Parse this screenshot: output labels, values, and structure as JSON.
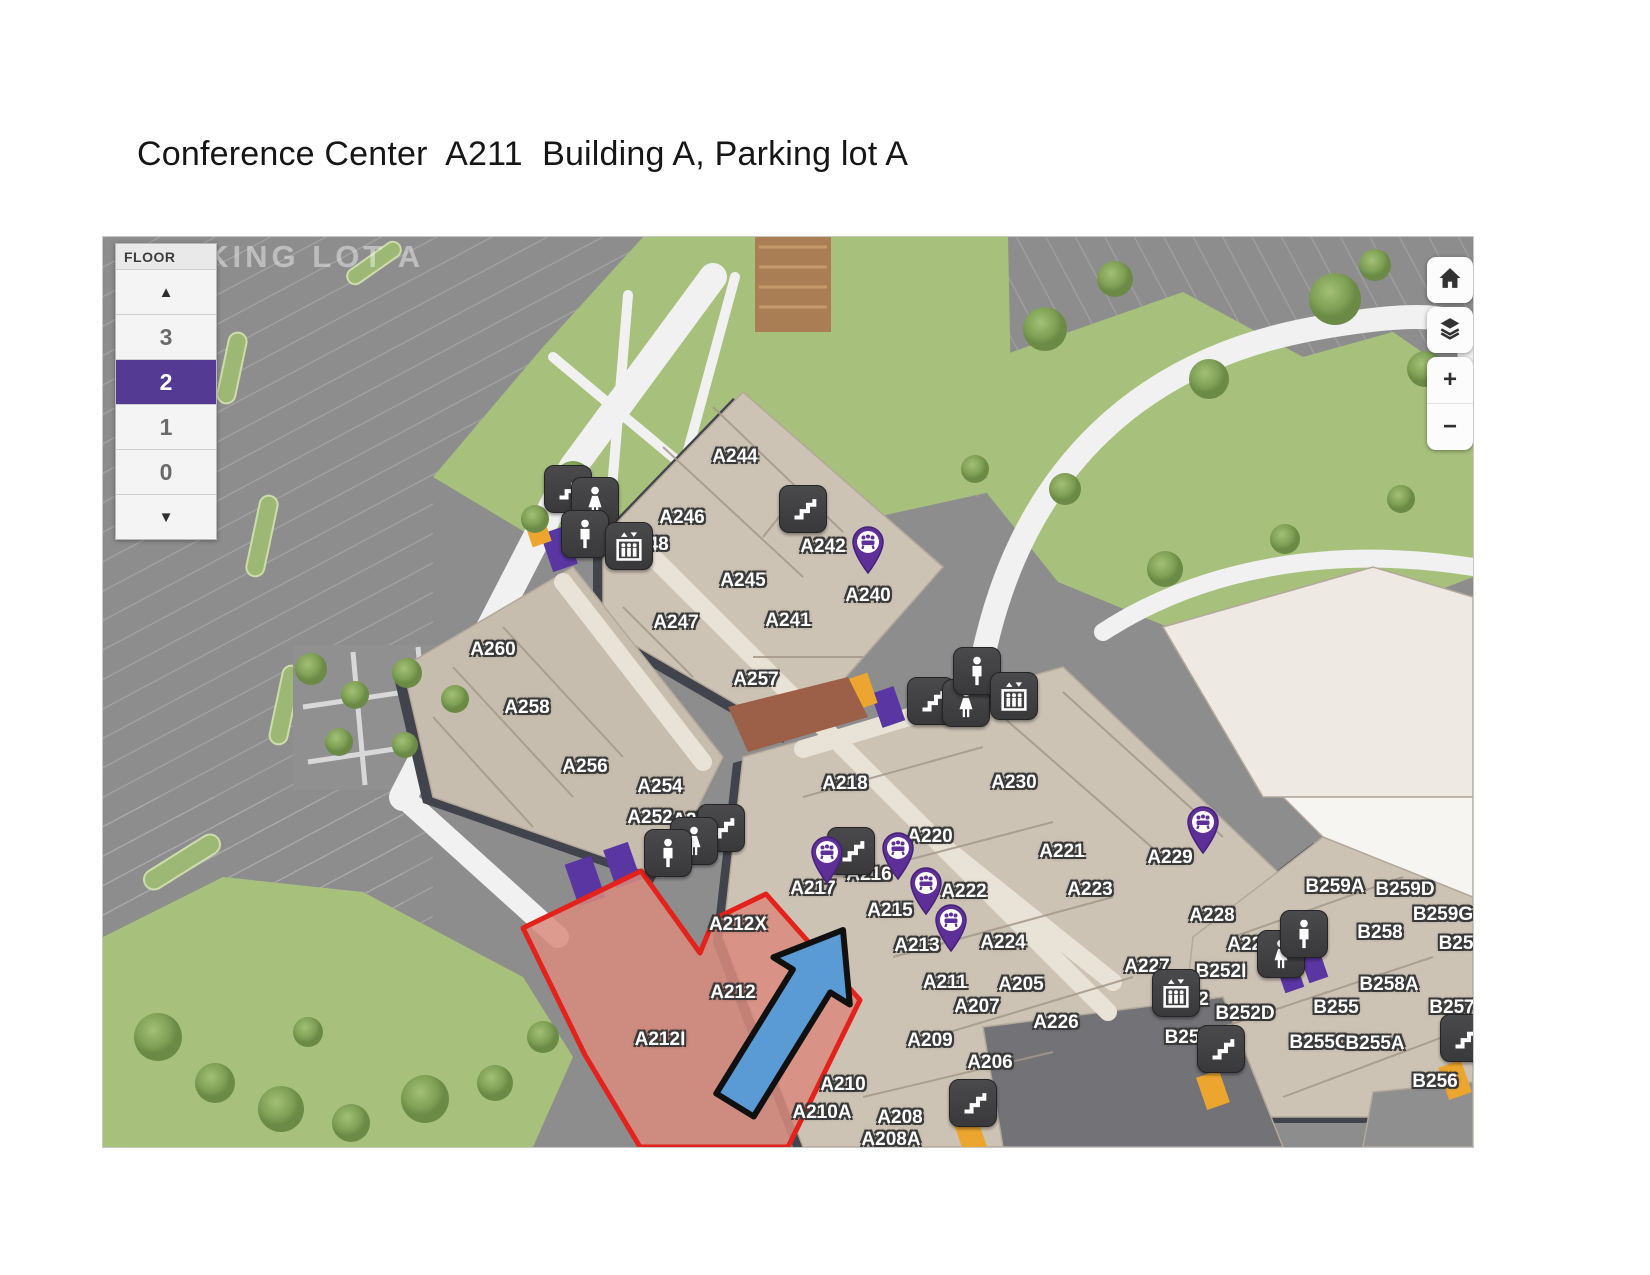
{
  "title": "Conference Center  A211  Building A, Parking lot A",
  "map": {
    "parking_lot_label": "PARKING LOT A",
    "floor_panel": {
      "header": "FLOOR",
      "up_arrow": "▲",
      "down_arrow": "▼",
      "floors": [
        "3",
        "2",
        "1",
        "0"
      ],
      "selected_floor": "2",
      "selected_color": "#543a93"
    },
    "controls": {
      "home": "home",
      "layers": "layers",
      "zoom_in": "+",
      "zoom_out": "−"
    },
    "colors": {
      "highlight_fill": "#d98b7e",
      "highlight_stroke": "#e3221b",
      "arrow_blue": "#5b9bd5",
      "pin_purple": "#5e2f96",
      "building_tan": "#cdc3b5",
      "parking_gray": "#8d8d8d",
      "grass_green": "#a7c07c"
    },
    "highlight_rooms": [
      "A212X",
      "A212",
      "A212I"
    ],
    "rooms": [
      {
        "label": "A244",
        "x": 632,
        "y": 220
      },
      {
        "label": "A246",
        "x": 579,
        "y": 281
      },
      {
        "label": "A248",
        "x": 543,
        "y": 308
      },
      {
        "label": "A242",
        "x": 720,
        "y": 310
      },
      {
        "label": "A245",
        "x": 640,
        "y": 344
      },
      {
        "label": "A240",
        "x": 765,
        "y": 359
      },
      {
        "label": "A247",
        "x": 573,
        "y": 386
      },
      {
        "label": "A241",
        "x": 685,
        "y": 384
      },
      {
        "label": "A260",
        "x": 390,
        "y": 413
      },
      {
        "label": "A257",
        "x": 653,
        "y": 443
      },
      {
        "label": "A258",
        "x": 424,
        "y": 471
      },
      {
        "label": "A256",
        "x": 482,
        "y": 530
      },
      {
        "label": "A254",
        "x": 557,
        "y": 550
      },
      {
        "label": "A252",
        "x": 547,
        "y": 581
      },
      {
        "label": "A250",
        "x": 592,
        "y": 584
      },
      {
        "label": "A218",
        "x": 742,
        "y": 547
      },
      {
        "label": "A230",
        "x": 911,
        "y": 546
      },
      {
        "label": "A220",
        "x": 827,
        "y": 600
      },
      {
        "label": "A221",
        "x": 959,
        "y": 615
      },
      {
        "label": "A216",
        "x": 766,
        "y": 638
      },
      {
        "label": "A217",
        "x": 710,
        "y": 652
      },
      {
        "label": "A222",
        "x": 861,
        "y": 655
      },
      {
        "label": "A223",
        "x": 987,
        "y": 653
      },
      {
        "label": "A215",
        "x": 787,
        "y": 674
      },
      {
        "label": "A213",
        "x": 814,
        "y": 709
      },
      {
        "label": "A224",
        "x": 900,
        "y": 706
      },
      {
        "label": "A229",
        "x": 1067,
        "y": 621
      },
      {
        "label": "A228",
        "x": 1109,
        "y": 679
      },
      {
        "label": "A227",
        "x": 1044,
        "y": 730
      },
      {
        "label": "A225",
        "x": 1147,
        "y": 708
      },
      {
        "label": "A211",
        "x": 842,
        "y": 746
      },
      {
        "label": "A205",
        "x": 918,
        "y": 748
      },
      {
        "label": "A207",
        "x": 874,
        "y": 770
      },
      {
        "label": "A226",
        "x": 953,
        "y": 786
      },
      {
        "label": "A209",
        "x": 827,
        "y": 804
      },
      {
        "label": "A206",
        "x": 887,
        "y": 826
      },
      {
        "label": "A210",
        "x": 740,
        "y": 848
      },
      {
        "label": "A210A",
        "x": 719,
        "y": 876
      },
      {
        "label": "A208",
        "x": 797,
        "y": 881
      },
      {
        "label": "A208A",
        "x": 788,
        "y": 903
      },
      {
        "label": "A212X",
        "x": 635,
        "y": 688
      },
      {
        "label": "A212",
        "x": 630,
        "y": 756
      },
      {
        "label": "A212I",
        "x": 557,
        "y": 803
      },
      {
        "label": "B259A",
        "x": 1232,
        "y": 650
      },
      {
        "label": "B259D",
        "x": 1302,
        "y": 653
      },
      {
        "label": "B259G",
        "x": 1340,
        "y": 678
      },
      {
        "label": "B258",
        "x": 1277,
        "y": 696
      },
      {
        "label": "B25",
        "x": 1353,
        "y": 707
      },
      {
        "label": "B252I",
        "x": 1118,
        "y": 735
      },
      {
        "label": "B258A",
        "x": 1286,
        "y": 748
      },
      {
        "label": "B252",
        "x": 1083,
        "y": 763
      },
      {
        "label": "B252D",
        "x": 1142,
        "y": 777
      },
      {
        "label": "B255",
        "x": 1233,
        "y": 771
      },
      {
        "label": "B257",
        "x": 1349,
        "y": 771
      },
      {
        "label": "B25",
        "x": 1079,
        "y": 801
      },
      {
        "label": "B255C",
        "x": 1216,
        "y": 806
      },
      {
        "label": "B255A",
        "x": 1272,
        "y": 807
      },
      {
        "label": "B256",
        "x": 1332,
        "y": 845
      }
    ],
    "icons": [
      {
        "type": "stairs-icon",
        "x": 464,
        "y": 251
      },
      {
        "type": "stairs-icon",
        "x": 699,
        "y": 271
      },
      {
        "type": "stairs-icon",
        "x": 827,
        "y": 463
      },
      {
        "type": "stairs-icon",
        "x": 617,
        "y": 590
      },
      {
        "type": "stairs-icon",
        "x": 747,
        "y": 613
      },
      {
        "type": "stairs-icon",
        "x": 869,
        "y": 865
      },
      {
        "type": "stairs-icon",
        "x": 1117,
        "y": 811
      },
      {
        "type": "stairs-icon",
        "x": 1360,
        "y": 800
      },
      {
        "type": "restroom-women-icon",
        "x": 491,
        "y": 263
      },
      {
        "type": "restroom-women-icon",
        "x": 862,
        "y": 465
      },
      {
        "type": "restroom-women-icon",
        "x": 590,
        "y": 603
      },
      {
        "type": "restroom-women-icon",
        "x": 1177,
        "y": 716
      },
      {
        "type": "restroom-men-icon",
        "x": 481,
        "y": 296
      },
      {
        "type": "restroom-men-icon",
        "x": 873,
        "y": 433
      },
      {
        "type": "restroom-men-icon",
        "x": 564,
        "y": 615
      },
      {
        "type": "restroom-men-icon",
        "x": 1200,
        "y": 696
      },
      {
        "type": "elevator-icon",
        "x": 525,
        "y": 308
      },
      {
        "type": "elevator-icon",
        "x": 910,
        "y": 458
      },
      {
        "type": "elevator-icon",
        "x": 1072,
        "y": 755
      }
    ],
    "pins": [
      {
        "type": "conference-room-pin",
        "x": 765,
        "y": 335
      },
      {
        "type": "conference-room-pin",
        "x": 724,
        "y": 645
      },
      {
        "type": "conference-room-pin",
        "x": 795,
        "y": 641
      },
      {
        "type": "conference-room-pin",
        "x": 823,
        "y": 676
      },
      {
        "type": "conference-room-pin",
        "x": 848,
        "y": 713
      },
      {
        "type": "conference-room-pin",
        "x": 1100,
        "y": 615
      }
    ]
  }
}
